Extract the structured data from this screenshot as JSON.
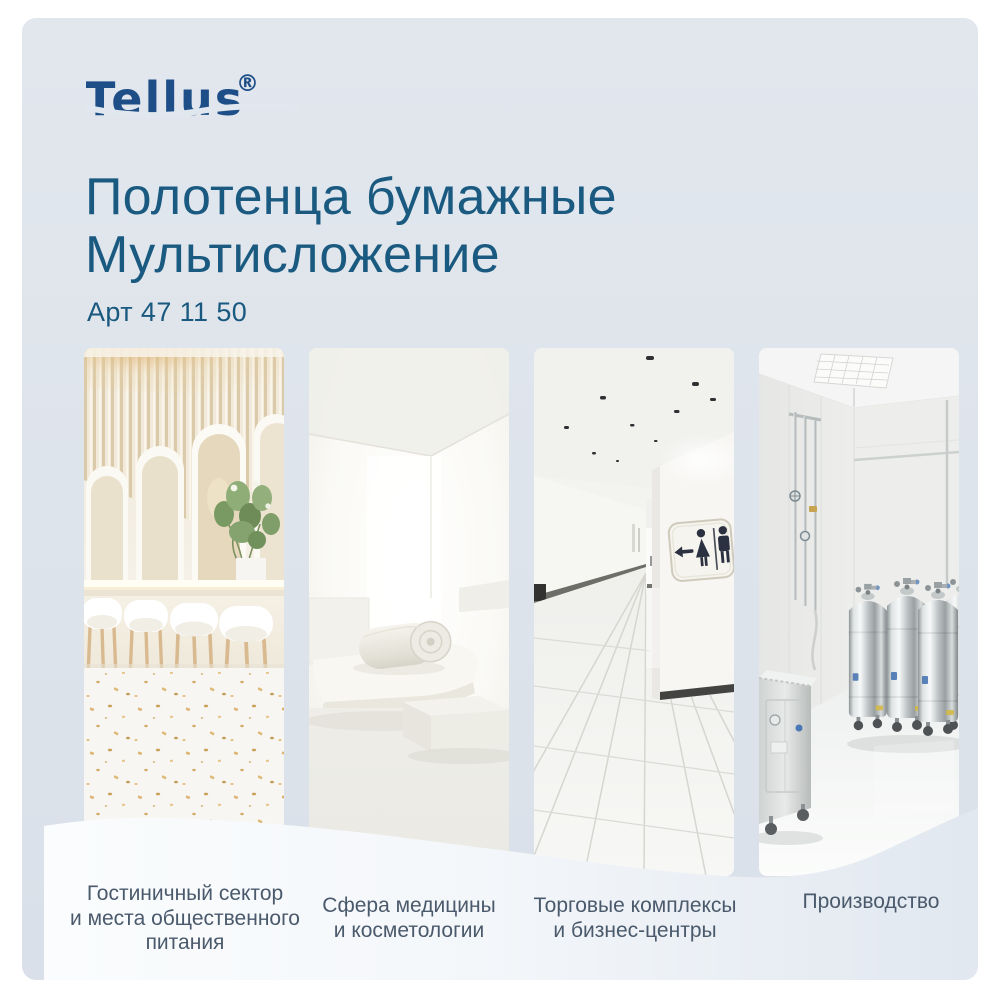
{
  "brand": {
    "logo_text": "Tellus",
    "registered_mark": "®"
  },
  "header": {
    "title_line1": "Полотенца бумажные",
    "title_line2": "Мультисложение",
    "sku": "Арт 47 11 50"
  },
  "categories": [
    {
      "name": "hotel-and-catering",
      "label_lines": [
        "Гостиничный сектор",
        "и места общественного",
        "питания"
      ],
      "image_subject": "light cafe interior with arches, bar stools and terrazzo floor"
    },
    {
      "name": "medicine-cosmetology",
      "label_lines": [
        "Сфера медицины",
        "и косметологии"
      ],
      "image_subject": "white spa room with massage bed and rolled towel"
    },
    {
      "name": "malls-business-centers",
      "label_lines": [
        "Торговые комплексы",
        "и бизнес-центры"
      ],
      "image_subject": "tiled corridor with restroom sign and ceiling spotlights"
    },
    {
      "name": "industrial",
      "label_lines": [
        "Производство"
      ],
      "image_subject": "production room with stainless steel tanks and pipes"
    }
  ],
  "colors": {
    "card_background": "#dfe5ec",
    "brand_navy": "#1d4e87",
    "title_blue": "#1a5a80",
    "label_slate": "#4a5a6c",
    "wave_white": "#fafcfd"
  }
}
